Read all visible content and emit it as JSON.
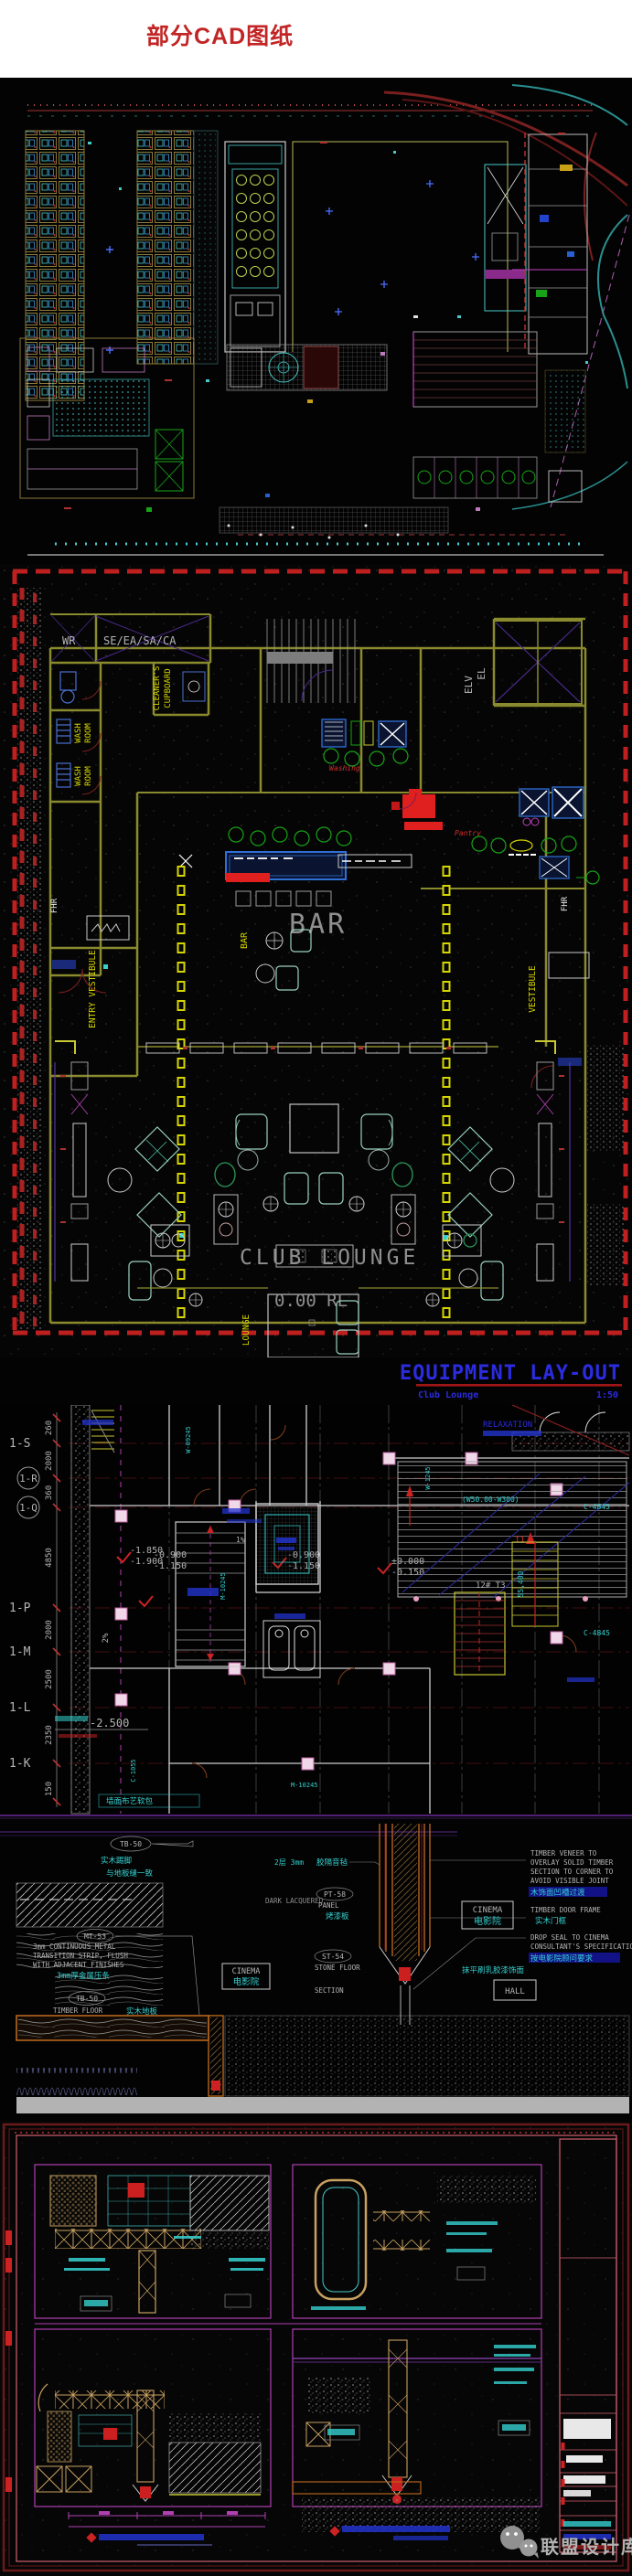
{
  "page": {
    "title": "部分CAD图纸"
  },
  "lounge": {
    "wr": "WR",
    "shaft": "SE/EA/SA/CA",
    "cleaners1": "CLEANER'S",
    "cleaners2": "CUPBOARD",
    "wash1": "WASH",
    "wash2": "ROOM",
    "entry": "ENTRY VESTIBULE",
    "vestibule": "VESTIBULE",
    "fhr": "FHR",
    "bar_small": "BAR",
    "bar_big": "BAR",
    "pantry": "Pantry",
    "washing": "Washing",
    "elv": "ELV",
    "el": "EL",
    "club": "CLUB LOUNGE",
    "level": "0.00 RL",
    "lounge_tag": "LOUNGE"
  },
  "banner": {
    "title": "EQUIPMENT LAY-OUT",
    "subtitle": "Club Lounge",
    "scale": "1:50"
  },
  "plan": {
    "grid": [
      "1-S",
      "1-R",
      "1-Q",
      "1-P",
      "1-M",
      "1-L",
      "1-K"
    ],
    "dims": [
      "260",
      "2000",
      "360",
      "4850",
      "2000",
      "2500",
      "2350",
      "150"
    ],
    "elev": {
      "a1": "-1.850",
      "a2": "-1.900",
      "b1": "-0.900",
      "b2": "-1.150",
      "c1": "±0.000",
      "c2": "-0.150",
      "d": "-2.500"
    },
    "codes": {
      "w1": "W-09245",
      "m1": "M-10245",
      "w2": "W-1245",
      "c4": "C-4845",
      "t1": "T1",
      "stair": "12# T3",
      "range": "(W50.00-W300)",
      "len": "55,400",
      "door": "C-1055"
    },
    "slope1": "2%",
    "slope2": "1%",
    "relax": "RELAXATION",
    "wallnote": "墙面布艺软包"
  },
  "det": {
    "tb50": "TB-50",
    "mt53": "MT-53",
    "pt58": "PT-58",
    "st54": "ST-54",
    "skirt1": "实木踢脚",
    "skirt2": "与地板缝一致",
    "metal1": "3mm CONTINUOUS METAL",
    "metal2": "TRANSITION STRIP, FLUSH",
    "metal3": "WITH ADJACENT FINISHES",
    "metalcn": "3mm厚金属压条",
    "tfloor": "TIMBER FLOOR",
    "tfloorcn": "实木地板",
    "layer": "2层 3mm",
    "dark": "DARK LACQUERED",
    "ven1": "TIMBER VENEER TO",
    "ven2": "OVERLAY SOLID TIMBER",
    "ven3": "SECTION TO CORNER TO",
    "ven4": "AVOID VISIBLE JOINT",
    "vencn": "木饰面凹槽过渡",
    "frame": "TIMBER DOOR FRAME",
    "framecn": "实木门框",
    "seal1": "DROP SEAL TO CINEMA",
    "seal2": "CONSULTANT'S SPECIFICATION",
    "sealcn": "按电影院顾问要求",
    "paintcn": "抹平刷乳胶漆饰面",
    "insul": "胶隔音毡",
    "panel": "PANEL",
    "panelcn": "烤漆板",
    "stone": "STONE FLOOR",
    "section": "SECTION",
    "cinema": "CINEMA",
    "cinemacn": "电影院",
    "hall": "HALL"
  },
  "wm": {
    "text": "联盟设计库"
  }
}
